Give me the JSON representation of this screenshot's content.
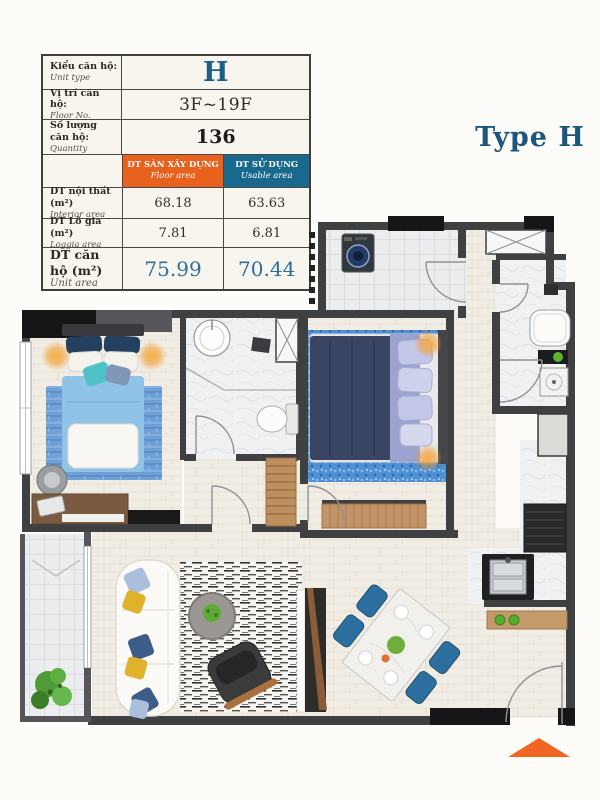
{
  "type_label": "Type H",
  "info_table": {
    "rows": [
      {
        "label_vi": "Kiểu căn hộ:",
        "label_en": "Unit type",
        "value": "H"
      },
      {
        "label_vi": "Vị trí căn hộ:",
        "label_en": "Floor No.",
        "value": "3F~19F"
      },
      {
        "label_vi": "Số lượng căn hộ:",
        "label_en": "Quantity",
        "value": "136"
      }
    ],
    "col_headers": [
      {
        "vi": "DT SÀN XÂY DỰNG",
        "en": "Floor area"
      },
      {
        "vi": "DT SỬ DỤNG",
        "en": "Usable area"
      }
    ],
    "area_rows": [
      {
        "label_vi": "DT nội thất (m²)",
        "label_en": "Interior area",
        "floor_area": "68.18",
        "usable_area": "63.63"
      },
      {
        "label_vi": "DT Lô gia (m²)",
        "label_en": "Loggia area",
        "floor_area": "7.81",
        "usable_area": "6.81"
      },
      {
        "label_vi": "DT căn hộ (m²)",
        "label_en": "Unit area",
        "floor_area": "75.99",
        "usable_area": "70.44"
      }
    ]
  },
  "colors": {
    "header_floor_bg": "#E8611D",
    "header_usable_bg": "#19698E",
    "accent_blue": "#1D5E86",
    "type_label_color": "#1D567D",
    "marker_orange": "#F16522"
  }
}
